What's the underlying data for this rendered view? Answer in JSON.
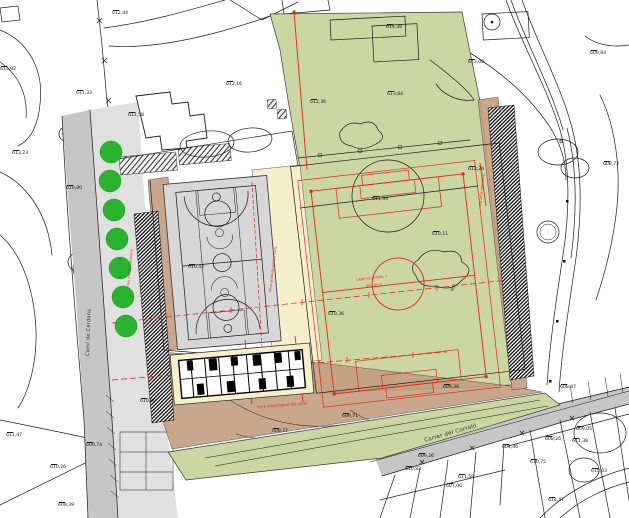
{
  "plan": {
    "colors": {
      "green": "#ccd6a2",
      "beige": "#f6efcb",
      "tan": "#c39d80",
      "court": "#d7d7d7",
      "road": "#c6c6c6",
      "sidewalk": "#e0e0e0",
      "tree": "#2ab32e",
      "red": "#e02818",
      "line": "#1b1b1b"
    },
    "street_labels": [
      {
        "text": "Camí de Cerdans",
        "x": 86,
        "y": 356,
        "rot": -88,
        "size": 5
      },
      {
        "text": "Carrer del Corraló",
        "x": 424,
        "y": 439,
        "rot": -16,
        "size": 5.5
      }
    ],
    "red_annotations": [
      {
        "text": "CAMP DE FUTBOL 7",
        "x": 356,
        "y": 279,
        "rot": -7,
        "size": 3.2
      },
      {
        "text": "65 x 45 m",
        "x": 366,
        "y": 285,
        "rot": -7,
        "size": 3.2
      },
      {
        "text": "nova graderia prefabricada",
        "x": 269,
        "y": 292,
        "rot": -83,
        "size": 3.4
      },
      {
        "text": "nou mur de contenció",
        "x": 127,
        "y": 286,
        "rot": -84,
        "size": 3.4
      },
      {
        "text": "nou talús enjardinat",
        "x": 479,
        "y": 207,
        "rot": -84,
        "size": 3.4
      },
      {
        "text": "nova urbanització del carrer",
        "x": 257,
        "y": 406,
        "rot": -4,
        "size": 3.6
      }
    ],
    "black_annotations": [
      {
        "text": "602",
        "x": 450,
        "y": 290,
        "rot": -62,
        "size": 4
      }
    ],
    "tree_radius": 11,
    "trees": [
      {
        "x": 111,
        "y": 152
      },
      {
        "x": 110,
        "y": 181
      },
      {
        "x": 114,
        "y": 210
      },
      {
        "x": 117,
        "y": 239
      },
      {
        "x": 120,
        "y": 268
      },
      {
        "x": 123,
        "y": 297
      },
      {
        "x": 126,
        "y": 326
      }
    ],
    "elevations": [
      {
        "x": 112,
        "y": 10,
        "v": "612,44"
      },
      {
        "x": 76,
        "y": 90,
        "v": "611,33"
      },
      {
        "x": 128,
        "y": 112,
        "v": "611,58"
      },
      {
        "x": 12,
        "y": 150,
        "v": "613,23"
      },
      {
        "x": 0,
        "y": 66,
        "v": "613,92"
      },
      {
        "x": 226,
        "y": 81,
        "v": "612,16"
      },
      {
        "x": 310,
        "y": 99,
        "v": "612,36"
      },
      {
        "x": 386,
        "y": 24,
        "v": "614,38"
      },
      {
        "x": 387,
        "y": 91,
        "v": "613,84"
      },
      {
        "x": 468,
        "y": 59,
        "v": "613,08"
      },
      {
        "x": 590,
        "y": 50,
        "v": "609,84"
      },
      {
        "x": 603,
        "y": 161,
        "v": "608,72"
      },
      {
        "x": 66,
        "y": 185,
        "v": "610,80"
      },
      {
        "x": 188,
        "y": 264,
        "v": "610,42"
      },
      {
        "x": 372,
        "y": 196,
        "v": "611,94"
      },
      {
        "x": 432,
        "y": 231,
        "v": "610,11"
      },
      {
        "x": 328,
        "y": 311,
        "v": "610,36"
      },
      {
        "x": 468,
        "y": 166,
        "v": "612,26"
      },
      {
        "x": 443,
        "y": 384,
        "v": "609,36"
      },
      {
        "x": 342,
        "y": 413,
        "v": "609,71"
      },
      {
        "x": 272,
        "y": 428,
        "v": "608,77"
      },
      {
        "x": 6,
        "y": 432,
        "v": "611,47"
      },
      {
        "x": 86,
        "y": 442,
        "v": "609,74"
      },
      {
        "x": 50,
        "y": 464,
        "v": "610,26"
      },
      {
        "x": 58,
        "y": 502,
        "v": "609,39"
      },
      {
        "x": 140,
        "y": 398,
        "v": "610,00"
      },
      {
        "x": 560,
        "y": 384,
        "v": "608,47"
      },
      {
        "x": 576,
        "y": 426,
        "v": "609,05"
      },
      {
        "x": 572,
        "y": 438,
        "v": "611,38"
      },
      {
        "x": 545,
        "y": 436,
        "v": "608,26"
      },
      {
        "x": 405,
        "y": 466,
        "v": "610,83"
      },
      {
        "x": 458,
        "y": 474,
        "v": "611,58"
      },
      {
        "x": 446,
        "y": 483,
        "v": "607,06"
      },
      {
        "x": 530,
        "y": 459,
        "v": "610,75"
      },
      {
        "x": 591,
        "y": 468,
        "v": "615,03"
      },
      {
        "x": 548,
        "y": 497,
        "v": "614,47"
      },
      {
        "x": 502,
        "y": 444,
        "v": "604,46"
      },
      {
        "x": 418,
        "y": 453,
        "v": "609,26"
      }
    ]
  }
}
